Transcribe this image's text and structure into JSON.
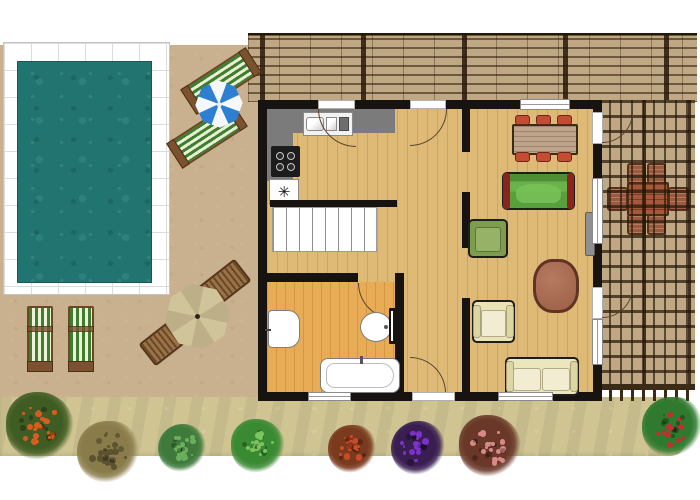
{
  "scene": {
    "type": "architectural floor plan",
    "description": "Top view plan of a single-storey house with swimming pool terrace, pergola roof, pergola deck and flower-lined garden path"
  },
  "palette": {
    "pool_water": "#21746f",
    "pool_tiles": "#ffffff",
    "patio": "#c9b190",
    "garden_path": "#cfc492",
    "pergola_wood": "#3a2a16",
    "house_floor": "#deba76",
    "bathroom_floor": "#e7ac55",
    "walls": "#171310",
    "kitchen_counter": "#7b7b7b",
    "green_sofa": "#58a03e",
    "cream_furniture": "#ece6bc",
    "dining_chair": "#c34d33",
    "umbrella_blue": "#2e7fd0",
    "parasol_sand": "#cfc49a"
  },
  "outdoor": {
    "pool": {
      "shape": "rectangle",
      "tiled_border": true
    },
    "pool_loungers": {
      "count": 2,
      "stripes": "green-white"
    },
    "beach_umbrella": {
      "segments": 8,
      "colors": [
        "#2e7fd0",
        "#ffffff"
      ]
    },
    "deck_chairs": {
      "count": 2,
      "stripes": "green-white"
    },
    "parasol_set": {
      "umbrella_segments": 8,
      "benches": 2
    },
    "pergola_roof": {
      "position": "top",
      "slats": "horizontal"
    },
    "pergola_deck": {
      "position": "right",
      "grid": true,
      "dining_chairs": 6,
      "dining_table": 1
    }
  },
  "house": {
    "kitchen": {
      "appliance_symbol": "✳",
      "stove_burners": 4,
      "sink_basins": 2
    },
    "staircase": {
      "steps": 8
    },
    "bathroom": {
      "fixtures": [
        "washbasin",
        "toilet",
        "bathtub"
      ]
    },
    "living_dining": {
      "furniture": [
        "dining-table",
        "green-sofa",
        "green-armchair",
        "rug",
        "cream-armchair",
        "cream-sofa"
      ],
      "dining_chairs": [
        [
          248,
          6
        ],
        [
          269,
          6
        ],
        [
          290,
          6
        ],
        [
          248,
          43
        ],
        [
          269,
          43
        ],
        [
          290,
          43
        ]
      ]
    }
  },
  "garden": {
    "plants": [
      {
        "name": "orange-flower-bush",
        "x": 40,
        "y": 426,
        "r": 34,
        "base": "#3f5c22",
        "dots": "#d85c1e"
      },
      {
        "name": "olive-bush",
        "x": 108,
        "y": 452,
        "r": 31,
        "base": "#8a7c4a",
        "dots": "#5c5230"
      },
      {
        "name": "green-bush",
        "x": 182,
        "y": 448,
        "r": 24,
        "base": "#3f7a3c",
        "dots": "#6ab05c"
      },
      {
        "name": "green-bush",
        "x": 258,
        "y": 446,
        "r": 27,
        "base": "#3a8a33",
        "dots": "#7cc45e"
      },
      {
        "name": "red-flower-bush",
        "x": 352,
        "y": 449,
        "r": 24,
        "base": "#7a3a1e",
        "dots": "#cc4a28"
      },
      {
        "name": "purple-flower-bush",
        "x": 418,
        "y": 448,
        "r": 27,
        "base": "#3a1e52",
        "dots": "#7a32c8"
      },
      {
        "name": "pink-flower-bush",
        "x": 490,
        "y": 446,
        "r": 31,
        "base": "#6a3828",
        "dots": "#d88a8a"
      },
      {
        "name": "red-green-bush",
        "x": 672,
        "y": 427,
        "r": 30,
        "base": "#2f7a2f",
        "dots": "#c03030"
      }
    ]
  }
}
